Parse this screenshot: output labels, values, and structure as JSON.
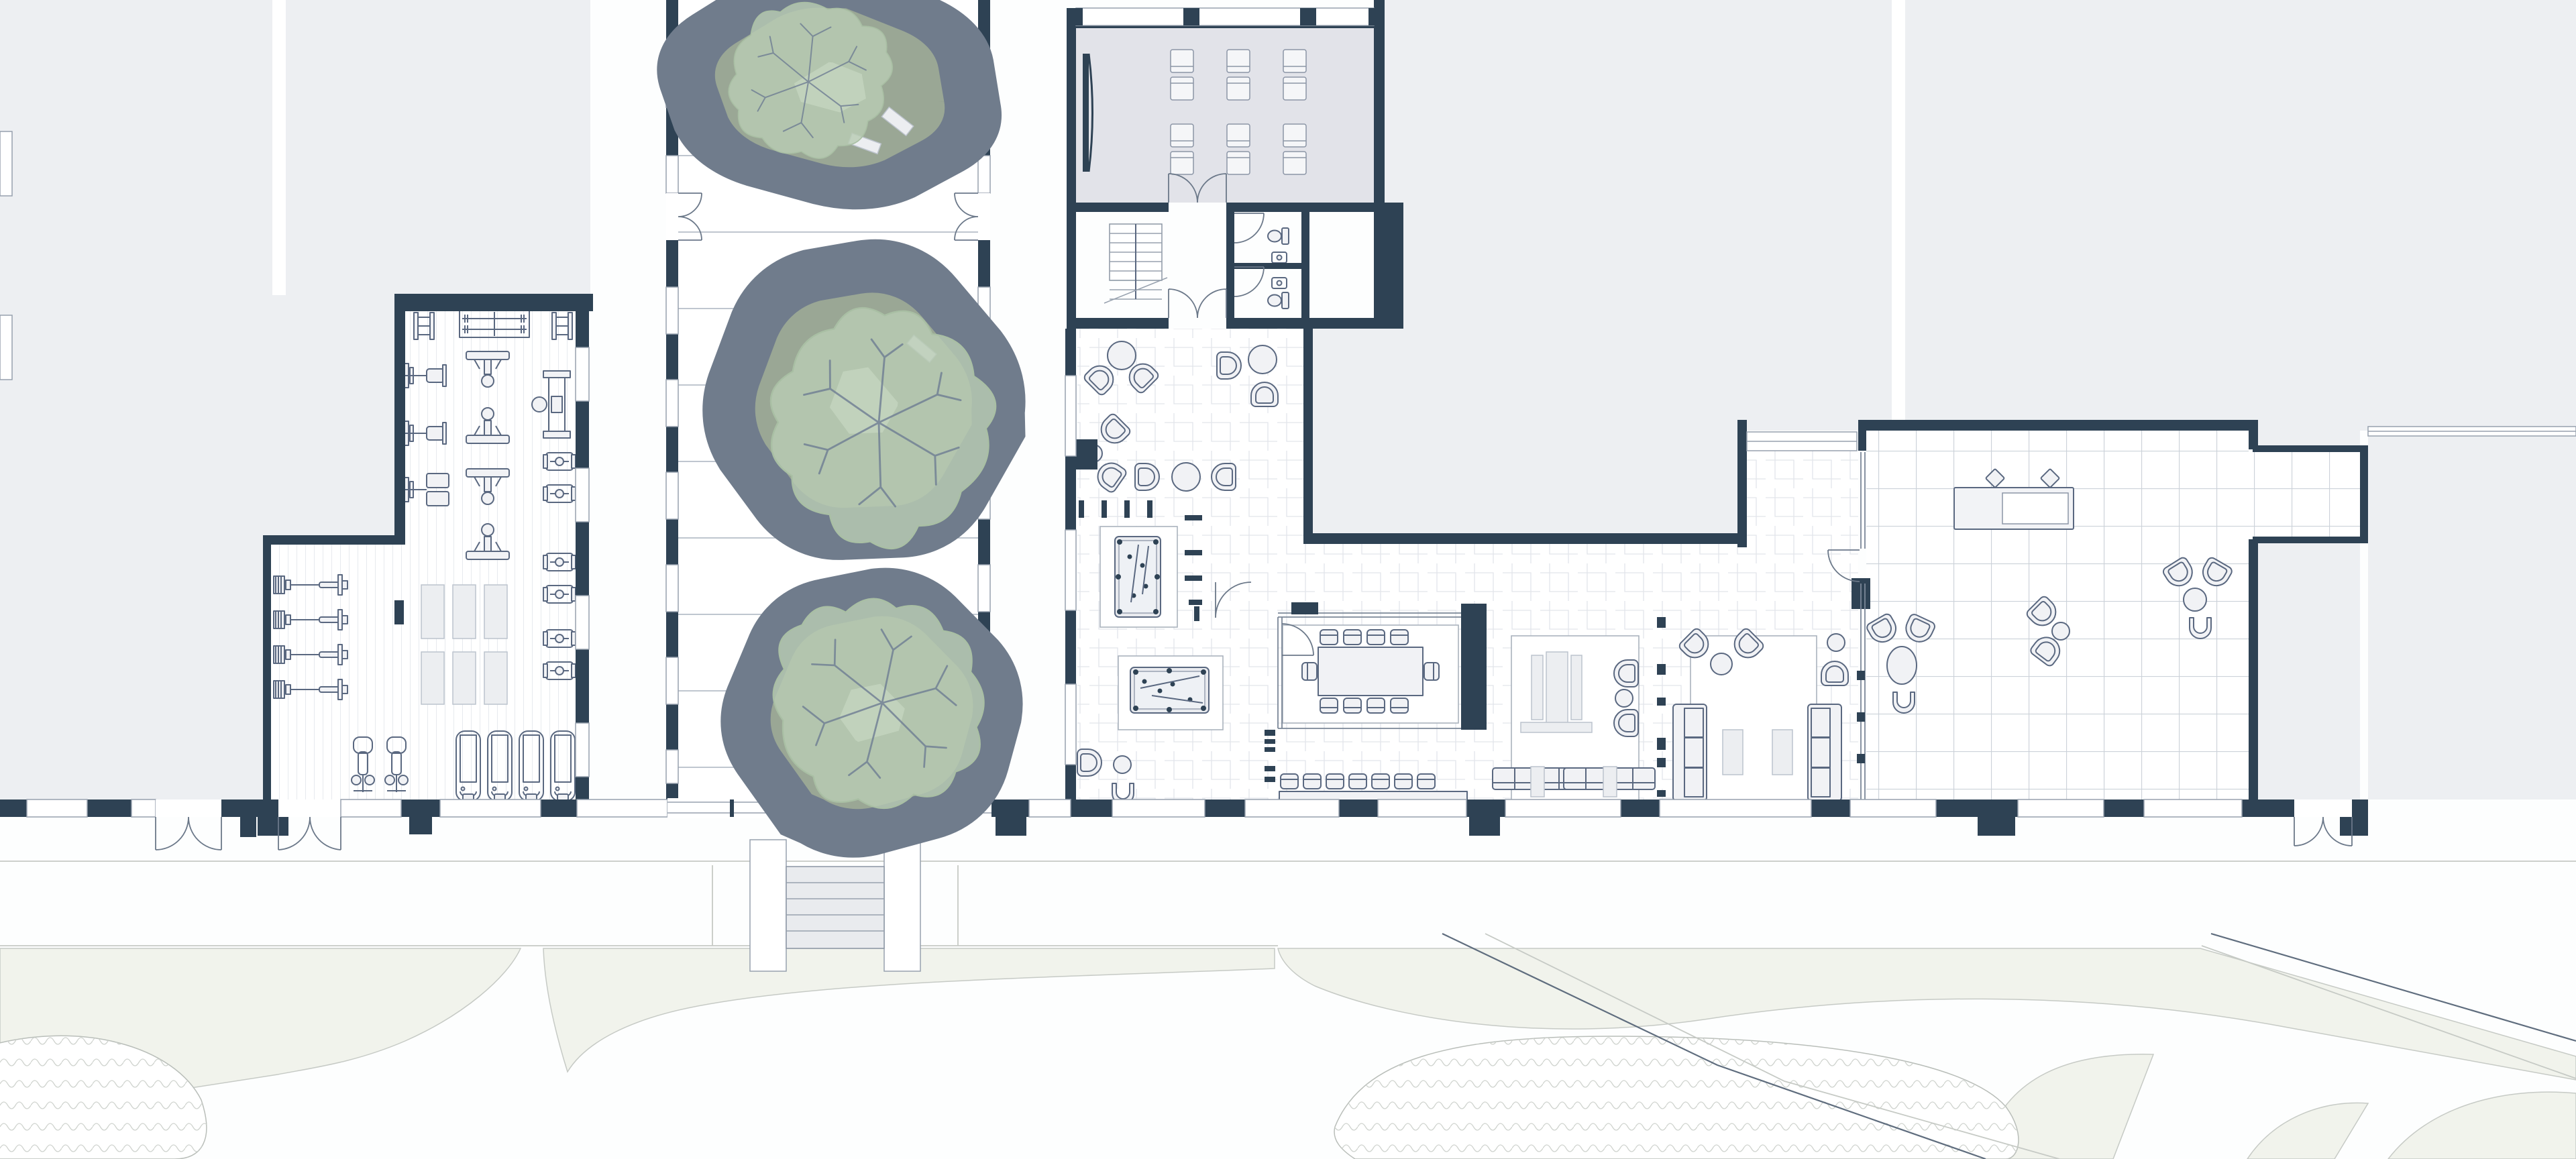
{
  "drawing": {
    "kind": "architectural floor plan, ground floor amenity level, top-down",
    "visible_text": "none",
    "scale_bar": "none",
    "north_arrow": "none"
  },
  "colors": {
    "paper": "#fdfefe",
    "wall": "#2e4254",
    "exterior": "#edeff2",
    "roomgray": "#e2e3e9",
    "line": "#5a6880",
    "thin": "#97a1ae",
    "furn": "#f1f2f5",
    "mat": "#eceef1",
    "courtline": "#aab3bf",
    "canopy": "#b8ccb3",
    "branch": "#6d7c92",
    "ring": "#d9dbd5",
    "planterin": "#e9efe1",
    "lawn": "#f1f3ec",
    "lsline": "#c6cac5",
    "road": "#5f6d7e"
  },
  "inventory": {
    "rooms": [
      "fitness-gym",
      "planted-courtyard",
      "screening-room",
      "entrance-vestibule-with-stairs",
      "two-restrooms",
      "herringbone-lounge",
      "billiards-area",
      "glass-dining-room",
      "media-room",
      "living-room",
      "tiled-cafe-lounge-with-bar"
    ],
    "trees": 3,
    "billiard_tables": 2,
    "screening_seats": 12,
    "treadmills": 4,
    "exercise_bikes": 2,
    "barbell_bench_rows": 4,
    "floor_mats": 6,
    "dining_table_seats": 10,
    "window_counter_stools": 7,
    "bar_stools": 2,
    "lounge_seating_groups": 9,
    "exterior_steps_flights": 1,
    "step_planter_boxes": 2
  }
}
